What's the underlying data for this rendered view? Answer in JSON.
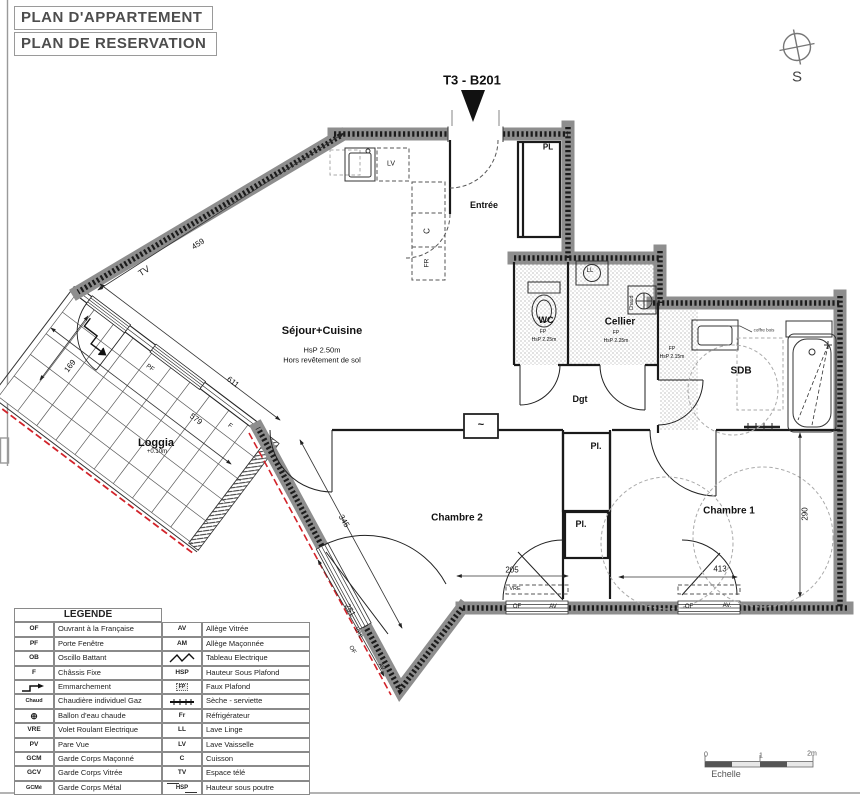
{
  "titles": {
    "plan_appartement": "PLAN D'APPARTEMENT",
    "plan_reservation": "PLAN DE RESERVATION"
  },
  "unit_label": "T3 - B201",
  "compass_south": "S",
  "rooms": {
    "entree": "Entrée",
    "sejour": {
      "name": "Séjour+Cuisine",
      "hsp": "HsP 2.50m",
      "note": "Hors revêtement de sol"
    },
    "loggia": {
      "name": "Loggia",
      "level": "+0.10m"
    },
    "wc": {
      "name": "WC",
      "fp": "FP",
      "hsp": "HsP 2.25m"
    },
    "cellier": {
      "name": "Cellier",
      "fp": "FP",
      "hsp": "HsP 2.25m"
    },
    "couloir": {
      "fp": "FP",
      "hsp": "HsP 2.15m"
    },
    "sdb": "SDB",
    "dgt": "Dgt",
    "chambre1": "Chambre 1",
    "chambre2": "Chambre 2",
    "pl_entree": "PL",
    "pl1": "Pl.",
    "pl2": "Pl."
  },
  "equipment": {
    "lv": "LV",
    "c": "C",
    "fr": "FR",
    "ll": "LL",
    "chaud": "Chaud",
    "coffre_bois": "coffre bois",
    "tableau": "~"
  },
  "openings": {
    "tv_wall": "TV",
    "pf_loggia": "PF",
    "f_loggia": "F",
    "w2": {
      "vre": "VRE",
      "of": "OF",
      "av": "AV"
    },
    "w1": {
      "of": "OF",
      "av": "AV."
    },
    "wd": {
      "vre": "VRE",
      "of": "OF",
      "av": "AV"
    }
  },
  "dimensions": {
    "d459": "459",
    "d611": "611",
    "d579": "579",
    "d169": "169",
    "d345": "345",
    "d251": "251",
    "d205": "205",
    "d413": "413",
    "d290": "290"
  },
  "legend": {
    "title": "LEGENDE",
    "rows": [
      {
        "la": "OF",
        "ll": "Ouvrant à la Française",
        "ra": "AV",
        "rl": "Allège Vitrée"
      },
      {
        "la": "PF",
        "ll": "Porte Fenêtre",
        "ra": "AM",
        "rl": "Allège Maçonnée"
      },
      {
        "la": "OB",
        "ll": "Oscillo Battant",
        "ra": "",
        "rl": "Tableau Electrique"
      },
      {
        "la": "F",
        "ll": "Châssis Fixe",
        "ra": "HSP",
        "rl": "Hauteur Sous Plafond"
      },
      {
        "la": "",
        "ll": "Emmarchement",
        "ra": "FP",
        "rl": "Faux Plafond"
      },
      {
        "la": "Chaud",
        "ll": "Chaudière individuel Gaz",
        "ra": "",
        "rl": "Sèche - serviette"
      },
      {
        "la": "⊕",
        "ll": "Ballon d'eau chaude",
        "ra": "Fr",
        "rl": "Réfrigérateur"
      },
      {
        "la": "VRE",
        "ll": "Volet Roulant Electrique",
        "ra": "LL",
        "rl": "Lave Linge"
      },
      {
        "la": "PV",
        "ll": "Pare Vue",
        "ra": "LV",
        "rl": "Lave Vaisselle"
      },
      {
        "la": "GCM",
        "ll": "Garde Corps Maçonné",
        "ra": "C",
        "rl": "Cuisson"
      },
      {
        "la": "GCV",
        "ll": "Garde Corps Vitrée",
        "ra": "TV",
        "rl": "Espace télé"
      },
      {
        "la": "GCMé",
        "ll": "Garde Corps Métal",
        "ra": "HSP",
        "rl": "Hauteur sous poutre"
      }
    ]
  },
  "scale": {
    "t0": "0",
    "t1": "1",
    "t2": "2m",
    "label": "Echelle"
  }
}
